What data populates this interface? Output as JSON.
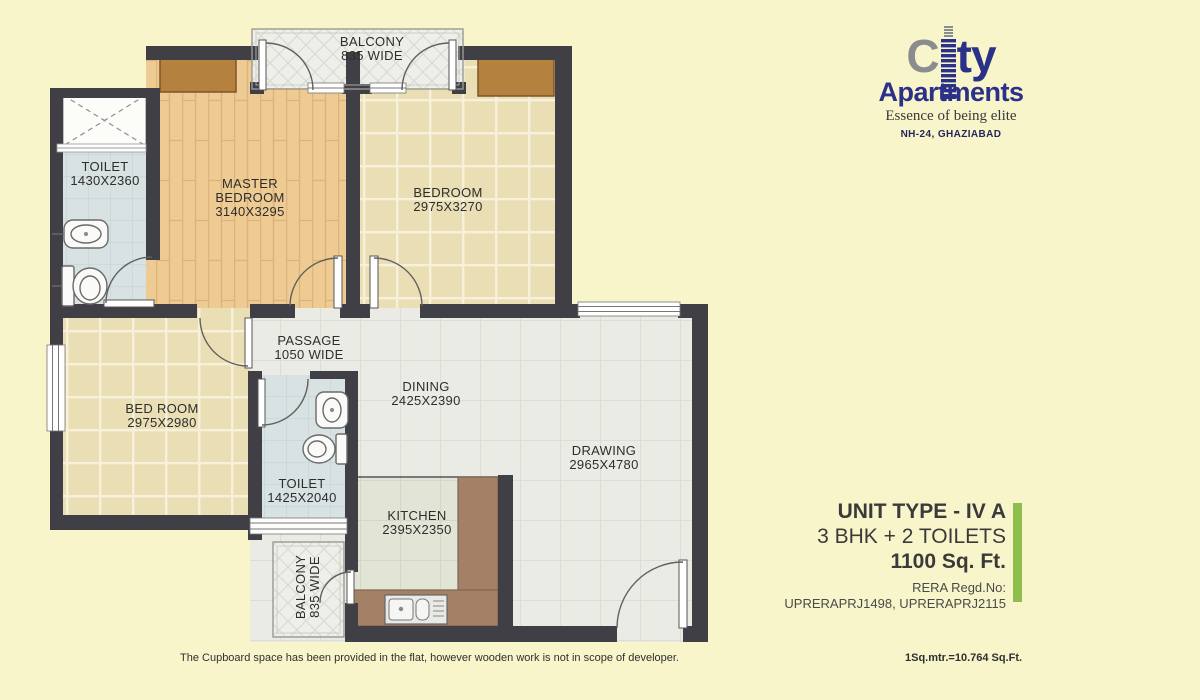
{
  "logo": {
    "word1_c": "C",
    "word1_rest": "ty",
    "word2": "Apartments",
    "tagline": "Essence of being elite",
    "location": "NH-24, GHAZIABAD"
  },
  "unit_info": {
    "unit_type": "UNIT TYPE - IV A",
    "configuration": "3 BHK + 2 TOILETS",
    "area": "1100 Sq. Ft.",
    "rera_label": "RERA Regd.No:",
    "rera_numbers": "UPRERAPRJ1498, UPRERAPRJ2115"
  },
  "footnotes": {
    "left": "The Cupboard space has been provided in the flat, however wooden work is not in scope of developer.",
    "right": "1Sq.mtr.=10.764 Sq.Ft."
  },
  "plan": {
    "rooms": {
      "balcony_top": {
        "name": "BALCONY",
        "dims": "835 WIDE"
      },
      "toilet_master": {
        "name": "TOILET",
        "dims": "1430X2360"
      },
      "master_bedroom": {
        "name": "MASTER",
        "name2": "BEDROOM",
        "dims": "3140X3295"
      },
      "bedroom": {
        "name": "BEDROOM",
        "dims": "2975X3270"
      },
      "passage": {
        "name": "PASSAGE",
        "dims": "1050 WIDE"
      },
      "bed_room": {
        "name": "BED ROOM",
        "dims": "2975X2980"
      },
      "toilet_common": {
        "name": "TOILET",
        "dims": "1425X2040"
      },
      "dining": {
        "name": "DINING",
        "dims": "2425X2390"
      },
      "drawing": {
        "name": "DRAWING",
        "dims": "2965X4780"
      },
      "kitchen": {
        "name": "KITCHEN",
        "dims": "2395X2350"
      },
      "balcony_bottom": {
        "name": "BALCONY",
        "dims": "835 WIDE"
      }
    }
  },
  "colors": {
    "background": "#F9F5CB",
    "wall": "#3F3F45",
    "wood_floor": "#EDCB93",
    "tile_floor": "#EADEB4",
    "gray_floor": "#EBEBE5",
    "kitchen_floor": "#E2E5D6",
    "toilet_floor": "#D8E2E3",
    "balcony_floor": "#EFEFEA",
    "cupboard": "#B5813F",
    "kitchen_platform": "#A48166",
    "accent_green": "#8FBE4C",
    "brand_navy": "#2B3188",
    "brand_gray": "#8A8C8F"
  }
}
